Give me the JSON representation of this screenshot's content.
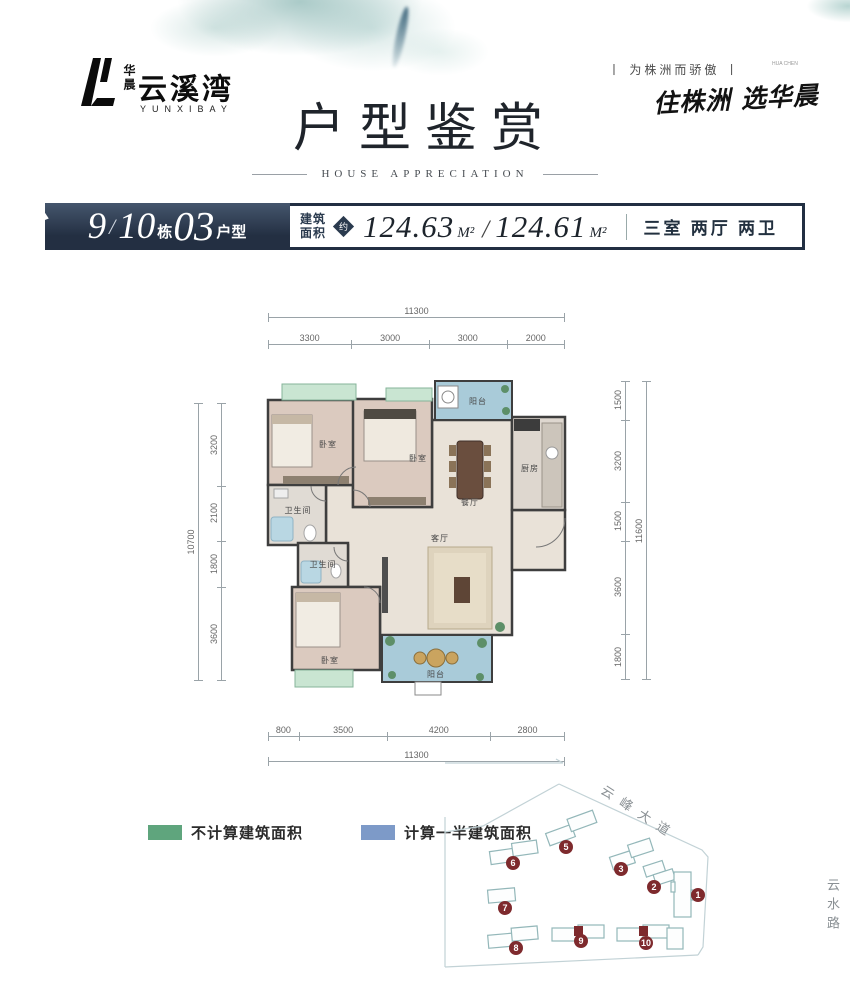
{
  "brand": {
    "company": "华晨",
    "name": "云溪湾",
    "name_en": "YUNXIBAY"
  },
  "tagline": {
    "slogan": "丨 为株洲而骄傲 丨",
    "slogan_small": "HUA CHEN",
    "calligraphy": "住株洲 选华晨"
  },
  "title": {
    "main": "户型鉴赏",
    "sub": "HOUSE APPRECIATION"
  },
  "header": {
    "building_no_1": "9",
    "divider": "/",
    "building_no_2": "10",
    "dong": "栋",
    "unit_no": "03",
    "unit_suffix": "户型",
    "area_label_line1": "建筑",
    "area_label_line2": "面积",
    "approx": "约",
    "area_1": "124.63",
    "area_unit_1": "M²",
    "area_slash": "/",
    "area_2": "124.61",
    "area_unit_2": "M²",
    "layout_spec": "三室 两厅 两卫"
  },
  "plan": {
    "dims": {
      "top_total": "11300",
      "top_segments": [
        "3300",
        "3000",
        "3000",
        "2000"
      ],
      "left_total": "10700",
      "left_segments": [
        "3200",
        "2100",
        "1800",
        "3600"
      ],
      "right_total": "11600",
      "right_segments": [
        "1500",
        "3200",
        "1500",
        "3600",
        "1800"
      ],
      "bottom_total": "11300",
      "bottom_segments": [
        "800",
        "3500",
        "4200",
        "2800"
      ]
    },
    "rooms": {
      "bedroom_tl": "卧室",
      "bedroom_mid": "卧室",
      "bedroom_b": "卧室",
      "bath1": "卫生间",
      "bath2": "卫生间",
      "kitchen": "厨房",
      "dining": "餐厅",
      "living": "客厅",
      "balcony_top": "阳台",
      "balcony_bottom": "阳台"
    }
  },
  "legend": {
    "green_label": "不计算建筑面积",
    "blue_label": "计算一半建筑面积",
    "green_color": "#5fa57d",
    "blue_color": "#7d9ac8"
  },
  "sitemap": {
    "road_top": "云峰大道",
    "road_right": "云水路",
    "buildings": [
      "5",
      "6",
      "3",
      "2",
      "1",
      "7",
      "8",
      "9",
      "10"
    ]
  },
  "colors": {
    "navy": "#232f42",
    "badge_red": "#7e2a2d",
    "balcony_blue": "#a9cbd9",
    "bay_green": "#c9e5d2",
    "wall": "#3e3e3e"
  }
}
